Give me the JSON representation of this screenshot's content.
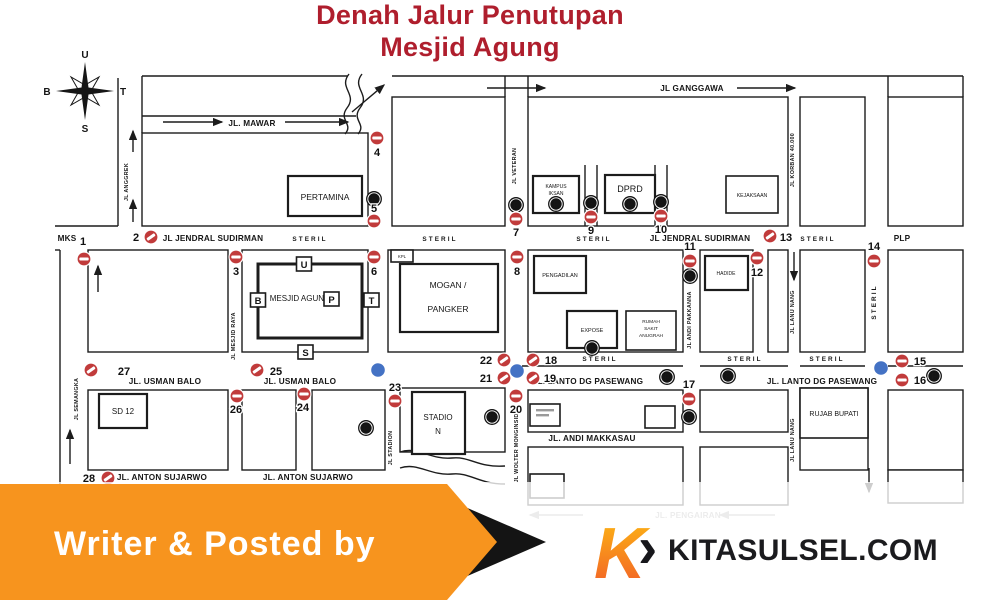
{
  "title": {
    "line1": "Denah Jalur Penutupan",
    "line2": "Mesjid Agung"
  },
  "compass": {
    "north": "U",
    "west": "B",
    "east": "T",
    "south": "S"
  },
  "areas": {
    "mks": "MKS",
    "plp": "PLP",
    "steril": "STERIL"
  },
  "streets": {
    "mawar": "JL. MAWAR",
    "ganggawa": "JL GANGGAWA",
    "jendral_sudirman": "JL JENDRAL SUDIRMAN",
    "usman_balo": "JL. USMAN BALO",
    "lanto_dg_pasewang": "JL. LANTO DG PASEWANG",
    "andi_makkasau": "JL. ANDI MAKKASAU",
    "anton_sujarwo": "JL. ANTON SUJARWO",
    "pengairan": "JL. PENGAIRAN",
    "anggrek": "JL ANGGREK",
    "veteran": "JL VETERAN",
    "korban_40000": "JL KORBAN 40.000",
    "mesjid_raya": "JL MESJID RAYA",
    "semangka": "JL SEMANGKA",
    "stadion": "JL STADION",
    "wolter_monginsidi": "JL WOLTER MONGINSIDI",
    "andi_pakkanna": "JL ANDI PAKKANNA",
    "lanu_nang": "JL LANU NANG"
  },
  "buildings": {
    "pertamina": "PERTAMINA",
    "mesjid_agung": "MESJID AGUNG",
    "mogan_line1": "MOGAN /",
    "mogan_line2": "PANGKER",
    "kpl": "KPL",
    "kampus_line1": "KAMPUS",
    "kampus_line2": "IKSAN",
    "dprd": "DPRD",
    "kejaksaan": "KEJAKSAAN",
    "pengadilan": "PENGADILAN",
    "expose": "EXPOSE",
    "rs_line1": "RUMAH",
    "rs_line2": "SAKIT",
    "rs_line3": "ANUGRAH",
    "hadide": "HADIDE",
    "sd12": "SD 12",
    "stadion_line1": "STADIO",
    "stadion_line2": "N",
    "rujab_bupati": "RUJAB BUPATI"
  },
  "mosque_gates": {
    "u": "U",
    "b": "B",
    "t": "T",
    "s": "S",
    "p": "P"
  },
  "points": {
    "p1": "1",
    "p2": "2",
    "p3": "3",
    "p4": "4",
    "p5": "5",
    "p6": "6",
    "p7": "7",
    "p8": "8",
    "p9": "9",
    "p10": "10",
    "p11": "11",
    "p12": "12",
    "p13": "13",
    "p14": "14",
    "p15": "15",
    "p16": "16",
    "p17": "17",
    "p18": "18",
    "p19": "19",
    "p20": "20",
    "p21": "21",
    "p22": "22",
    "p23": "23",
    "p24": "24",
    "p25": "25",
    "p26": "26",
    "p27": "27",
    "p28": "28"
  },
  "icons": {
    "parking": "P"
  },
  "banner": {
    "text": "Writer & Posted by"
  },
  "logo": {
    "k": "K",
    "chevron": "›",
    "site": "KITASULSEL.COM"
  },
  "colors": {
    "title_red": "#AF1E2D",
    "no_entry_red": "#C13B3B",
    "dot_blue": "#4472C4",
    "banner_orange": "#F7941E",
    "line_black": "#1C1C1C"
  }
}
